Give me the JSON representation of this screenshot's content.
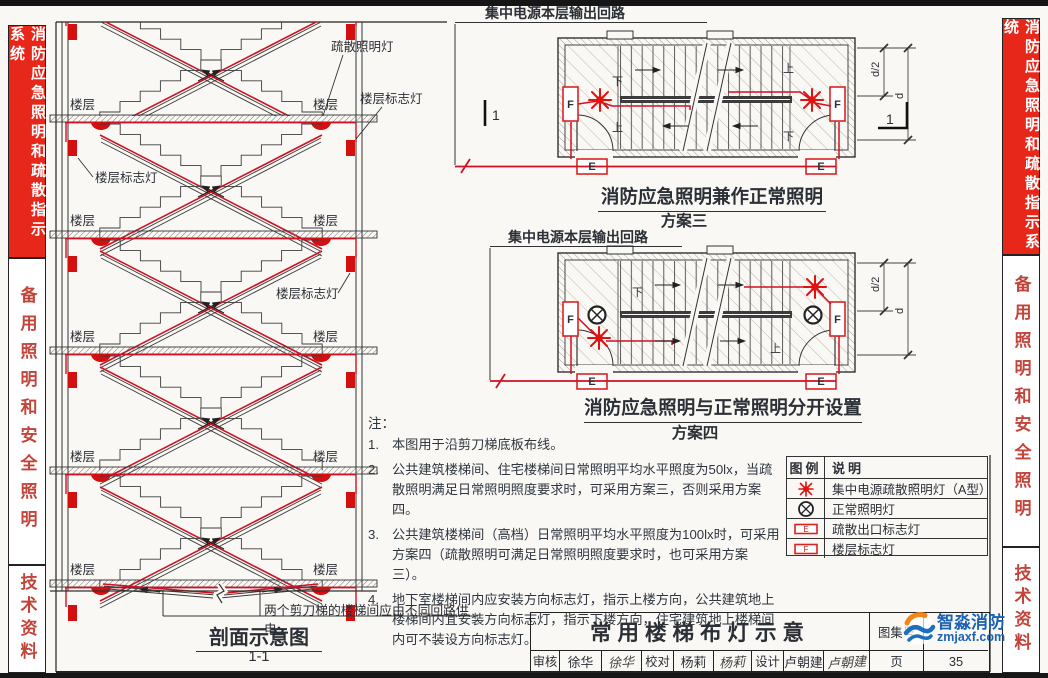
{
  "sidebars": {
    "system": "消防应急照明和疏散指示系统",
    "backup": "备用照明和安全照明",
    "tech": "技术资料"
  },
  "section_view": {
    "title": "剖面示意图",
    "subtitle": "1-1",
    "floor_label": "楼层",
    "floor_sign_label": "楼层标志灯",
    "evac_light_label": "疏散照明灯",
    "circuit_note": "两个剪刀梯的楼梯间应由不同回路供电"
  },
  "plans": {
    "circuit_label": "集中电源本层输出回路",
    "plan3": {
      "title": "消防应急照明兼作正常照明",
      "scheme": "方案三"
    },
    "plan4": {
      "title": "消防应急照明与正常照明分开设置",
      "scheme": "方案四"
    },
    "dim_half": "d/2",
    "dim_full": "d",
    "section_marker": "1",
    "f_label": "F",
    "e_label": "E",
    "up_label": "上",
    "down_label": "下"
  },
  "notes": {
    "heading": "注：",
    "items": [
      {
        "num": "1.",
        "text": "本图用于沿剪刀梯底板布线。"
      },
      {
        "num": "2.",
        "text": "公共建筑楼梯间、住宅楼梯间日常照明平均水平照度为50lx，当疏散照明满足日常照明照度要求时，可采用方案三，否则采用方案四。"
      },
      {
        "num": "3.",
        "text": "公共建筑楼梯间（高档）日常照明平均水平照度为100lx时，可采用方案四（疏散照明可满足日常照明照度要求时，也可采用方案三）。"
      },
      {
        "num": "4.",
        "text": "地下室楼梯间内应安装方向标志灯，指示上楼方向，公共建筑地上楼梯间内宜安装方向标志灯，指示下楼方向，住宅建筑地上楼梯间内可不装设方向标志灯。"
      }
    ]
  },
  "legend": {
    "col_symbol": "图例",
    "col_desc": "说明",
    "rows": [
      {
        "symbol": "a-type-evac-luminaire",
        "desc": "集中电源疏散照明灯（A型）"
      },
      {
        "symbol": "normal-luminaire",
        "desc": "正常照明灯"
      },
      {
        "symbol": "exit-sign",
        "desc": "疏散出口标志灯"
      },
      {
        "symbol": "floor-sign",
        "desc": "楼层标志灯"
      }
    ]
  },
  "titleblock": {
    "drawing_title": "常用楼梯布灯示意",
    "atlas_label": "图集号",
    "page_label": "页",
    "page_number": "35",
    "reviewer_label": "审核",
    "reviewer": "徐华",
    "reviewer_sig": "徐华",
    "checker_label": "校对",
    "checker": "杨莉",
    "checker_sig": "杨莉",
    "designer_label": "设计",
    "designer": "卢朝建",
    "designer_sig": "卢朝建"
  },
  "watermark": {
    "brand": "智淼消防",
    "domain": "zmjaxf.com"
  },
  "colors": {
    "sidebar_red": "#e8271b",
    "sidebar_text_red": "#c2453c",
    "wire_red": "#cf1124",
    "symbol_red": "#e01212",
    "watermark_blue": "#1b62b5"
  }
}
